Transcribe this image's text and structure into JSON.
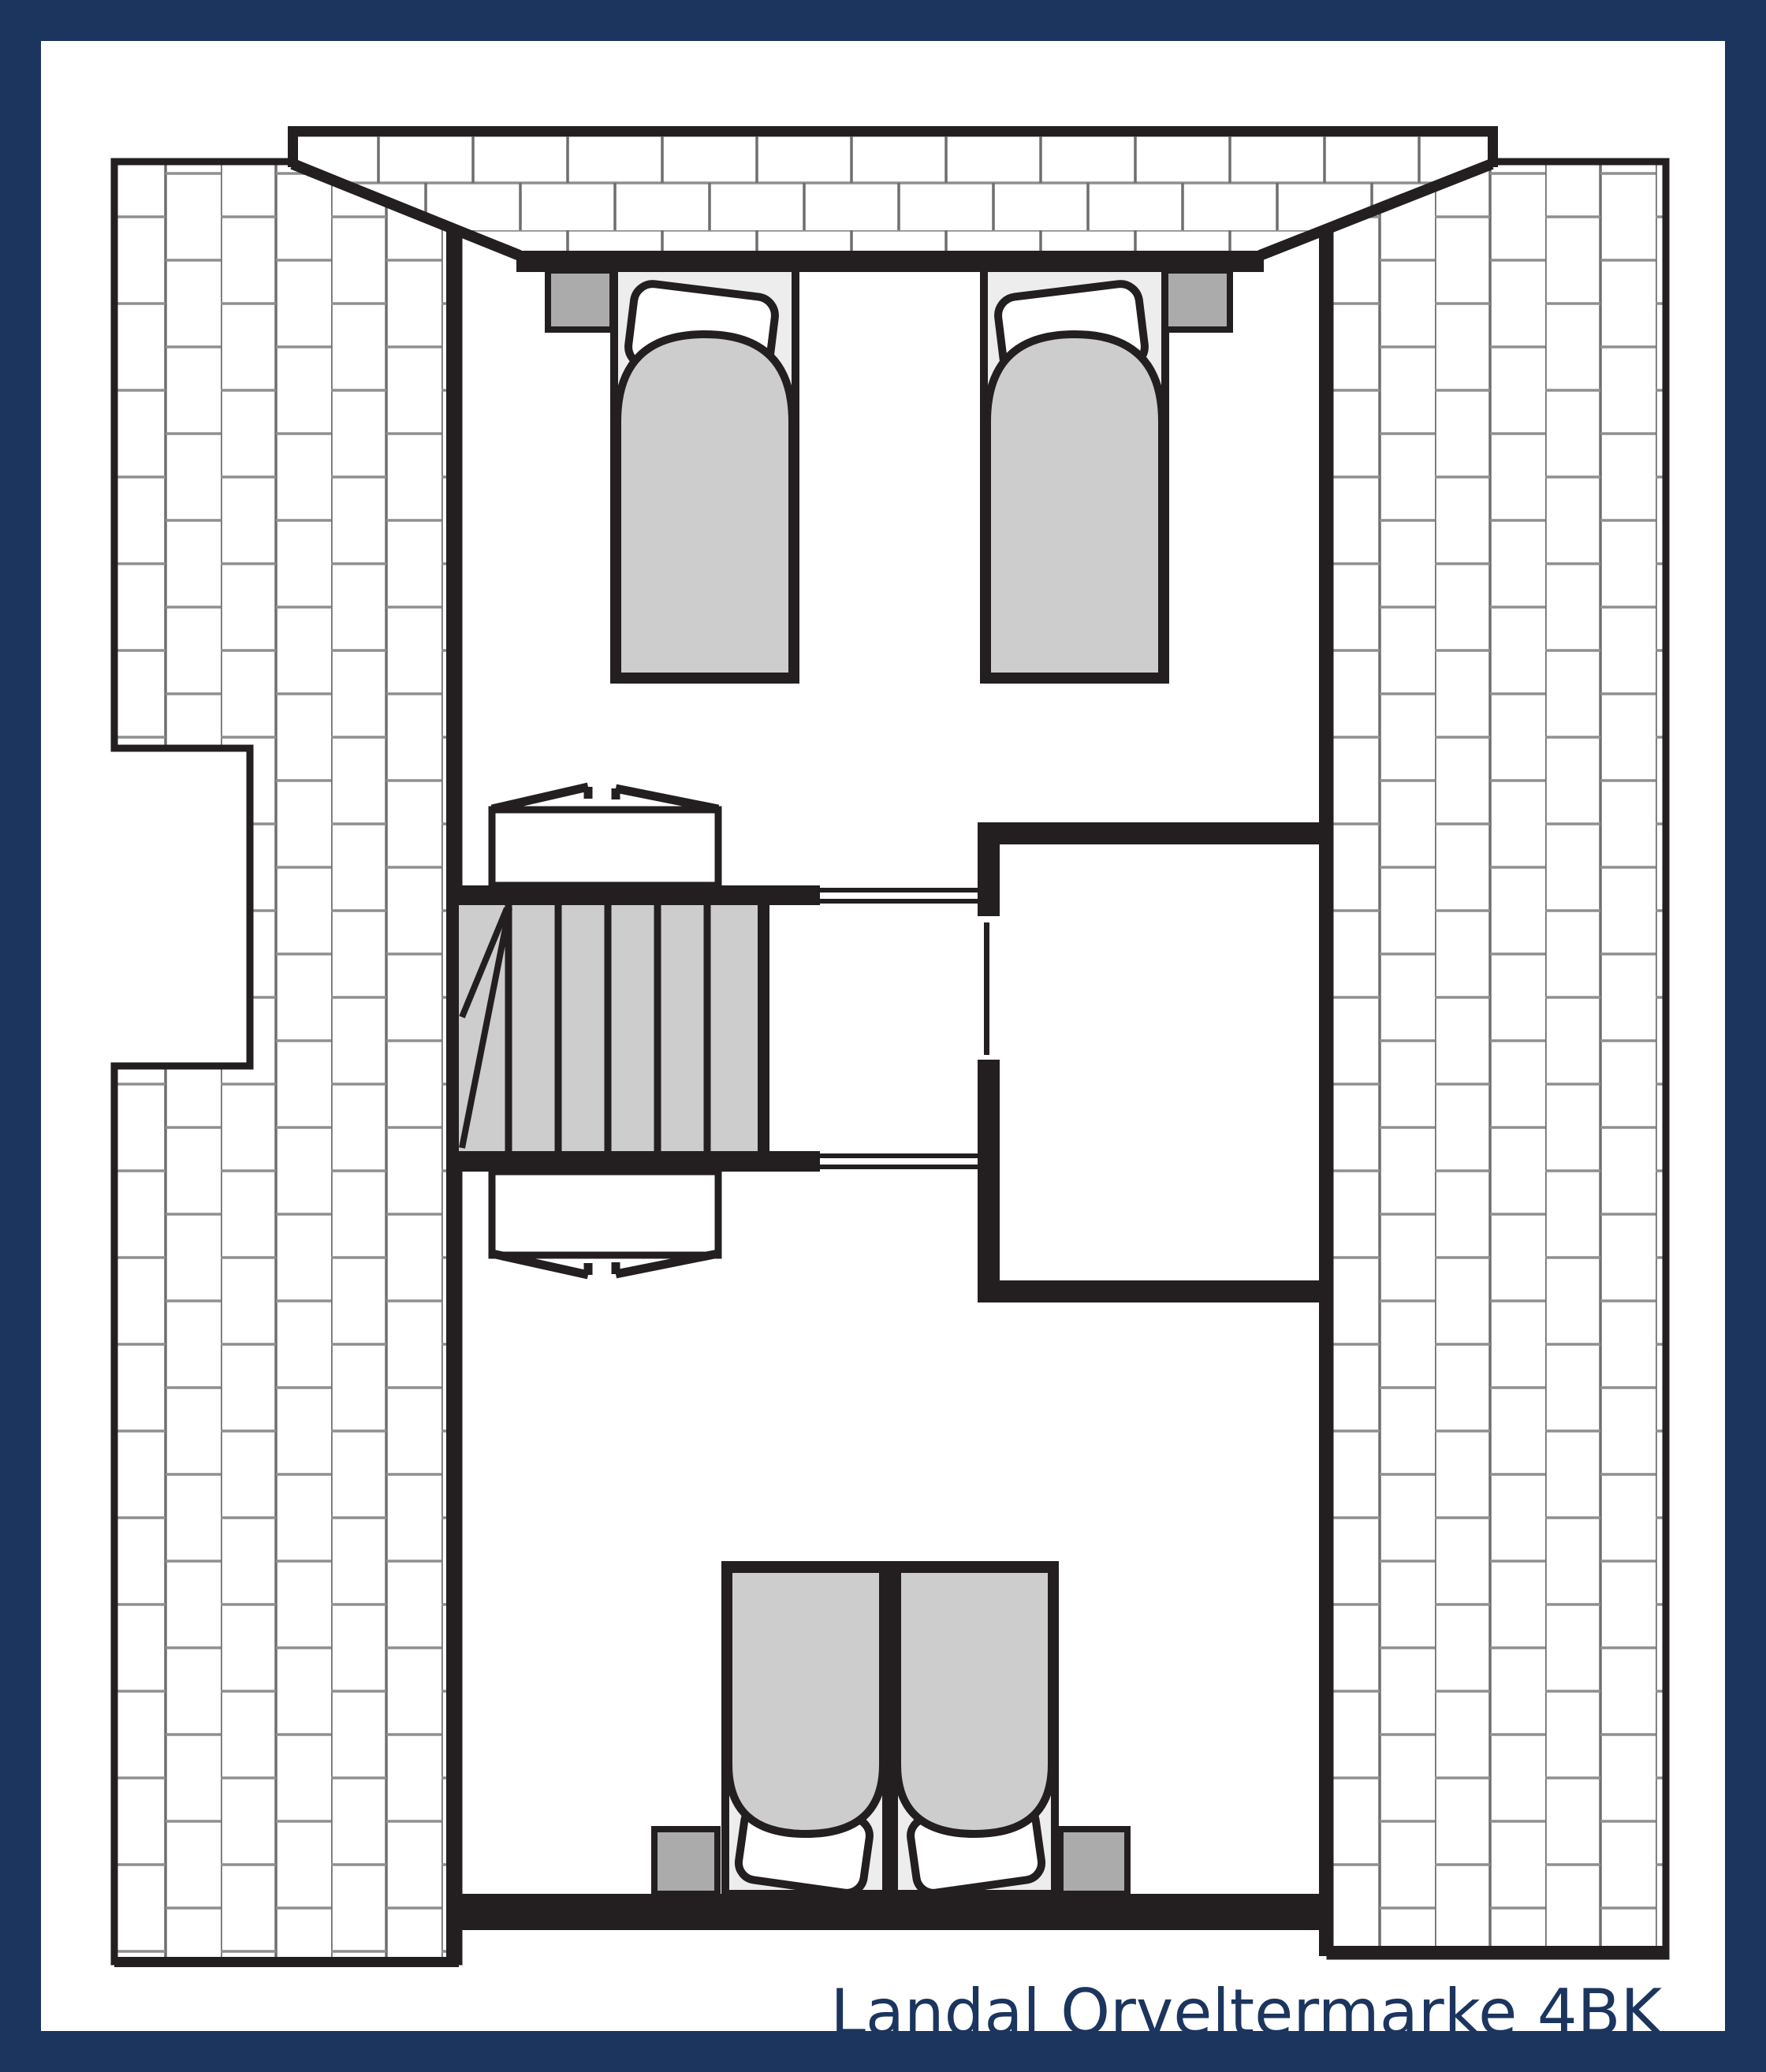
{
  "title": {
    "label": "Landal Orveltermarke 4BK"
  },
  "palette": {
    "navy": "#1b355e",
    "ink": "#231f20",
    "paper": "#ffffff",
    "duvet": "#cdcdcd",
    "mattress": "#ededed",
    "stand": "#ababab",
    "jointv": "#6e6e6e",
    "jointh": "#8f8f8f"
  },
  "plan": {
    "type": "floor-plan",
    "elements": [
      "masonry-gable-band",
      "masonry-side-wall-left",
      "masonry-side-wall-right",
      "single-bed-left",
      "single-bed-right",
      "nightstand",
      "staircase",
      "sloped-ceiling-marker",
      "storage-room",
      "sliding-door",
      "double-bed",
      "landing-railing"
    ]
  }
}
